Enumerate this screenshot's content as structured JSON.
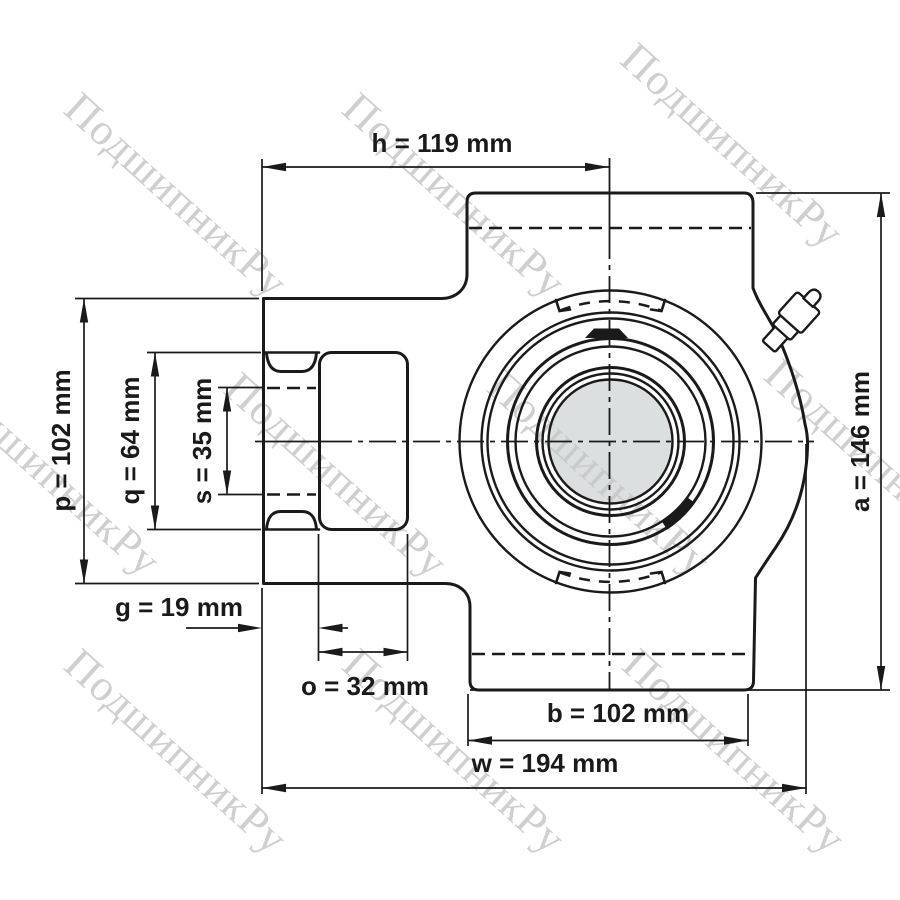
{
  "drawing": {
    "subject": "Take-up bearing unit housing with insert bearing — front view dimensional drawing",
    "line_color": "#1a1a1a",
    "bore_fill": "#dcdfe0"
  },
  "watermark": {
    "text": "ПодшипникРу",
    "color": "#c7c7c7"
  },
  "dimensions": {
    "h": {
      "letter": "h",
      "value": 119,
      "unit": "mm",
      "label": "h = 119 mm"
    },
    "p": {
      "letter": "p",
      "value": 102,
      "unit": "mm",
      "label": "p = 102 mm"
    },
    "q": {
      "letter": "q",
      "value": 64,
      "unit": "mm",
      "label": "q = 64 mm"
    },
    "s": {
      "letter": "s",
      "value": 35,
      "unit": "mm",
      "label": "s = 35 mm"
    },
    "g": {
      "letter": "g",
      "value": 19,
      "unit": "mm",
      "label": "g = 19 mm"
    },
    "o": {
      "letter": "o",
      "value": 32,
      "unit": "mm",
      "label": "o = 32 mm"
    },
    "b": {
      "letter": "b",
      "value": 102,
      "unit": "mm",
      "label": "b = 102 mm"
    },
    "w": {
      "letter": "w",
      "value": 194,
      "unit": "mm",
      "label": "w = 194 mm"
    },
    "a": {
      "letter": "a",
      "value": 146,
      "unit": "mm",
      "label": "a = 146 mm"
    }
  }
}
